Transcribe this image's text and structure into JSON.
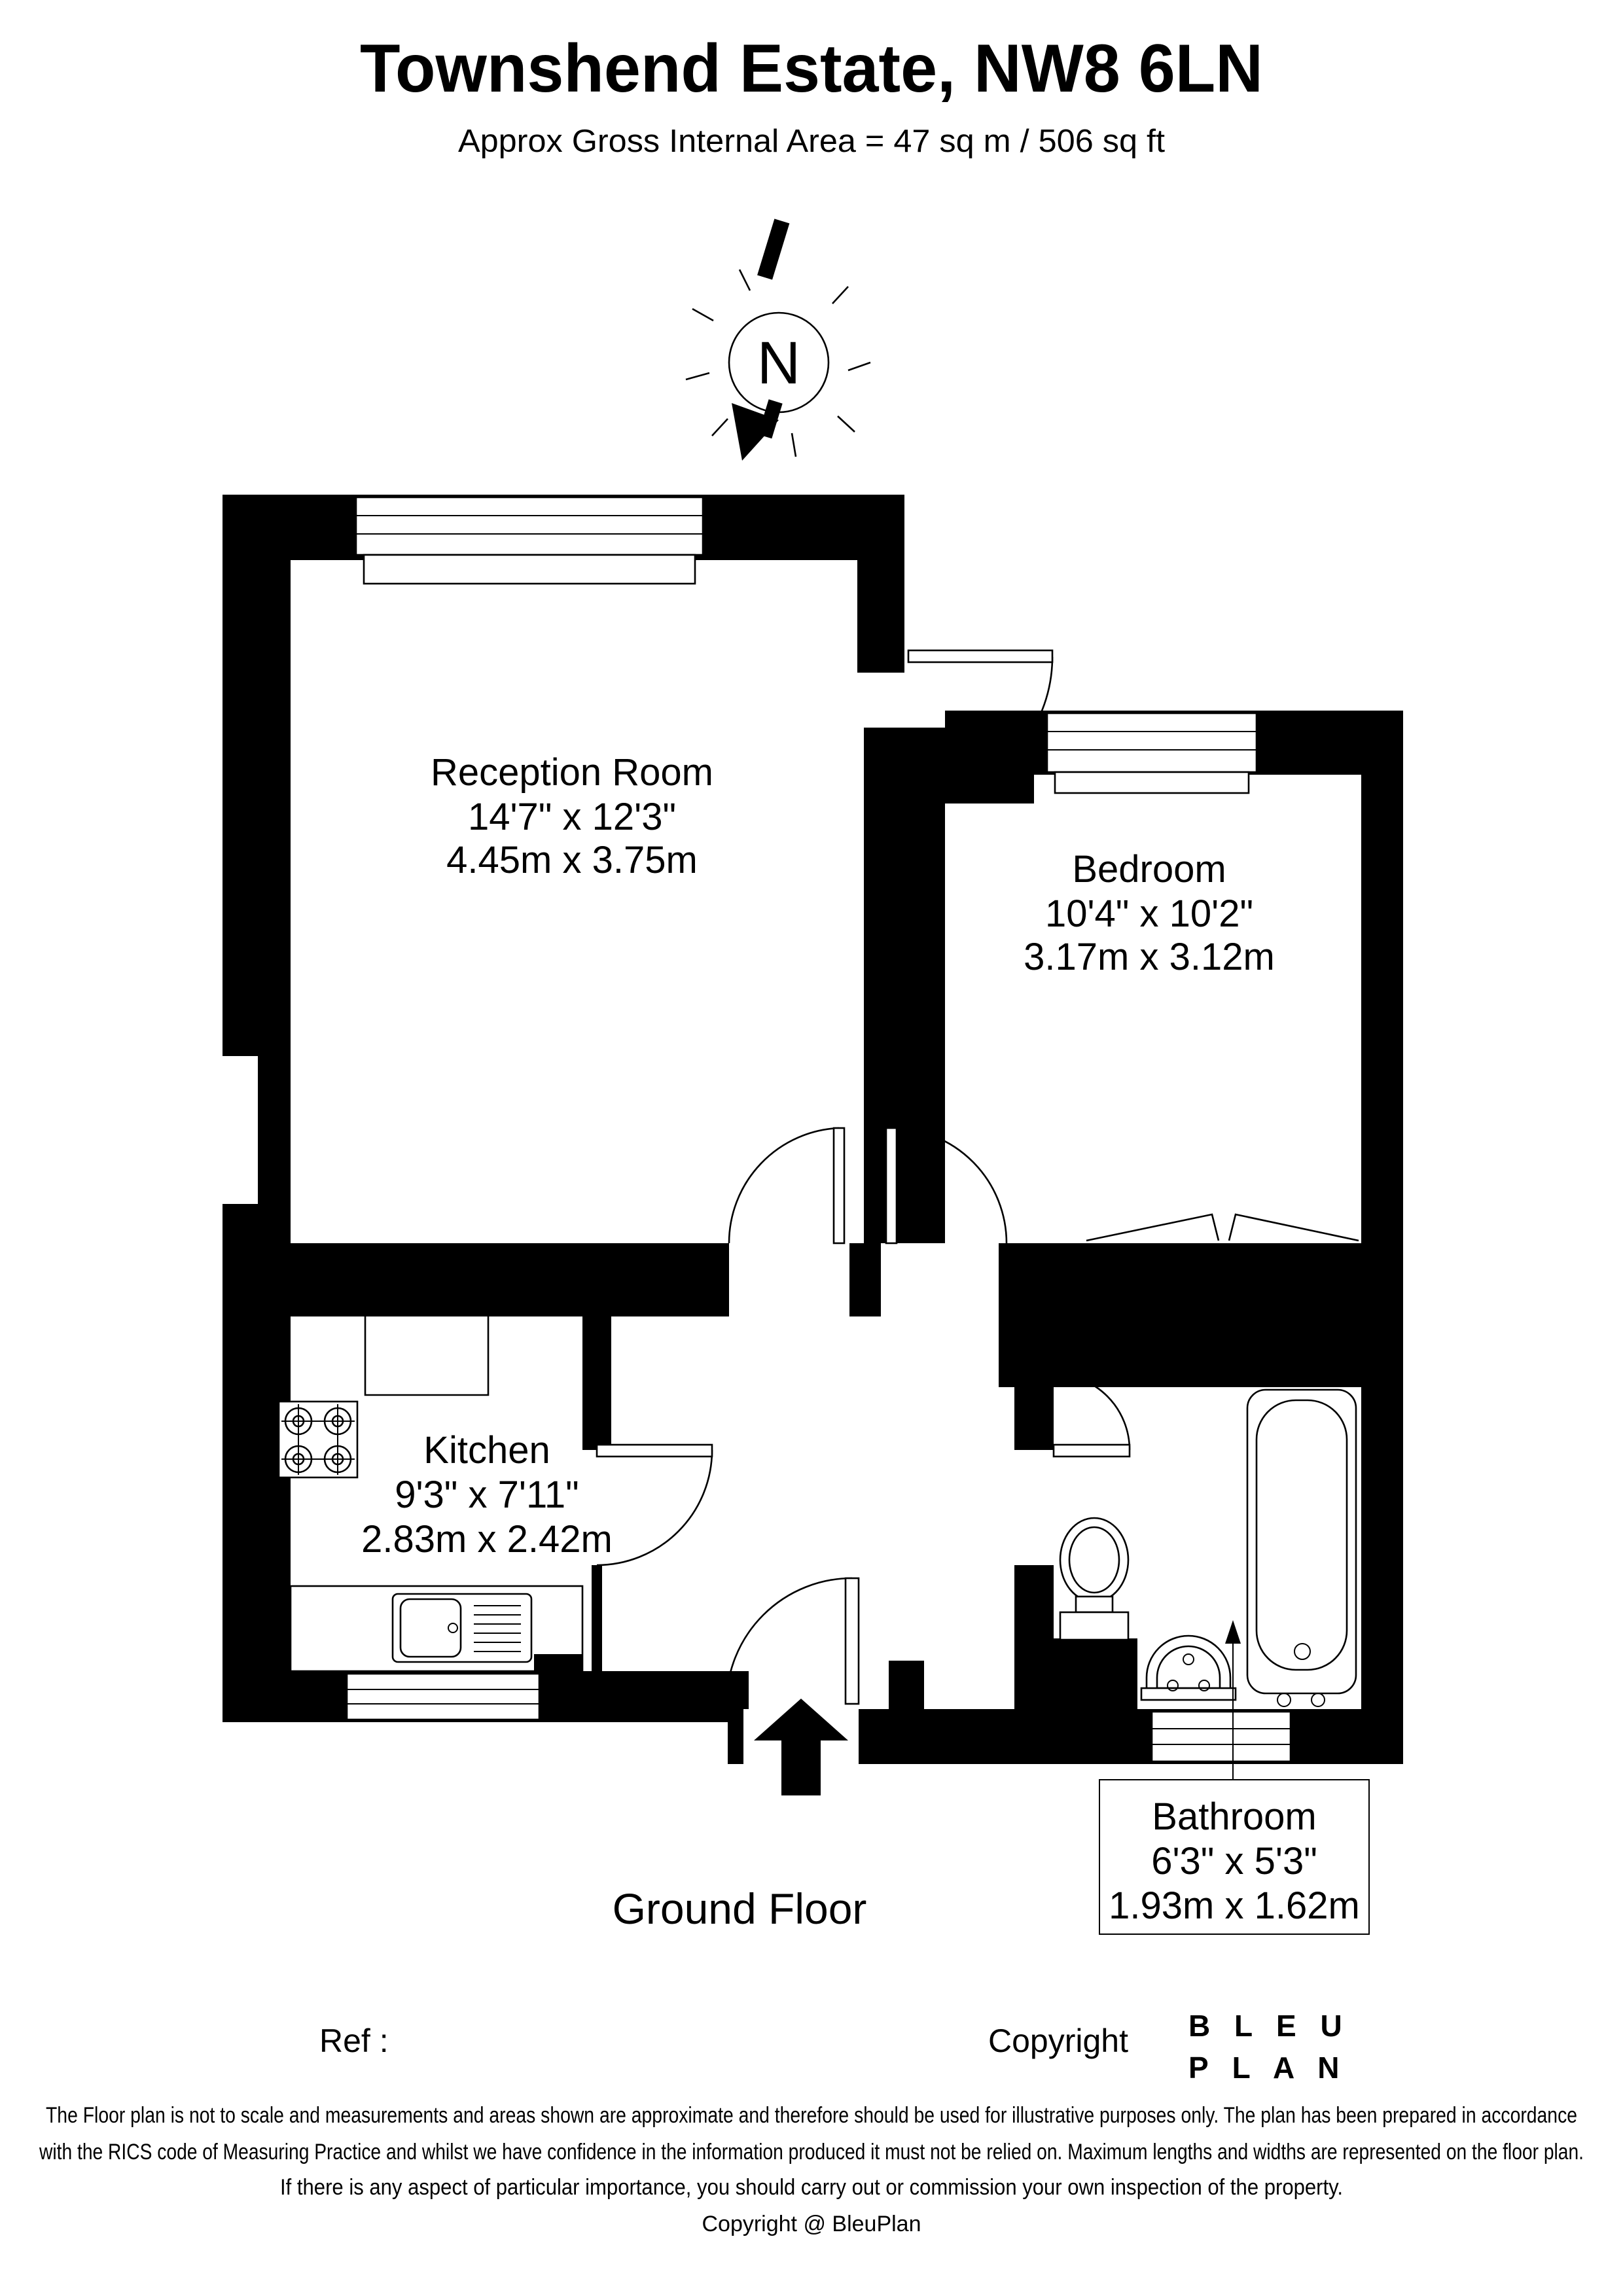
{
  "title": "Townshend Estate, NW8 6LN",
  "subtitle": "Approx Gross Internal Area = 47 sq m / 506 sq ft",
  "north": {
    "label": "N"
  },
  "floor_label": "Ground Floor",
  "rooms": {
    "reception": {
      "name": "Reception Room",
      "imperial": "14'7\" x 12'3\"",
      "metric": "4.45m x 3.75m"
    },
    "bedroom": {
      "name": "Bedroom",
      "imperial": "10'4\" x 10'2\"",
      "metric": "3.17m x 3.12m"
    },
    "kitchen": {
      "name": "Kitchen",
      "imperial": "9'3\" x 7'11\"",
      "metric": "2.83m x 2.42m"
    },
    "bathroom": {
      "name": "Bathroom",
      "imperial": "6'3\" x 5'3\"",
      "metric": "1.93m x 1.62m"
    }
  },
  "footer": {
    "ref_label": "Ref  :",
    "copyright_label": "Copyright",
    "logo_line1": "B L E U",
    "logo_line2": "P L A N",
    "logo_color": "#2e2a78"
  },
  "disclaimer": {
    "line1": "The Floor plan is not to scale and measurements and areas shown are approximate and therefore should be used for illustrative purposes only. The plan has been prepared in accordance",
    "line2": "with the RICS code of Measuring Practice and whilst we have confidence in the information produced it must not be relied on. Maximum lengths and widths are represented on the floor plan.",
    "line3": "If there is any aspect of particular importance, you should carry out or commission your own inspection of the property.",
    "line4": "Copyright @ BleuPlan"
  }
}
